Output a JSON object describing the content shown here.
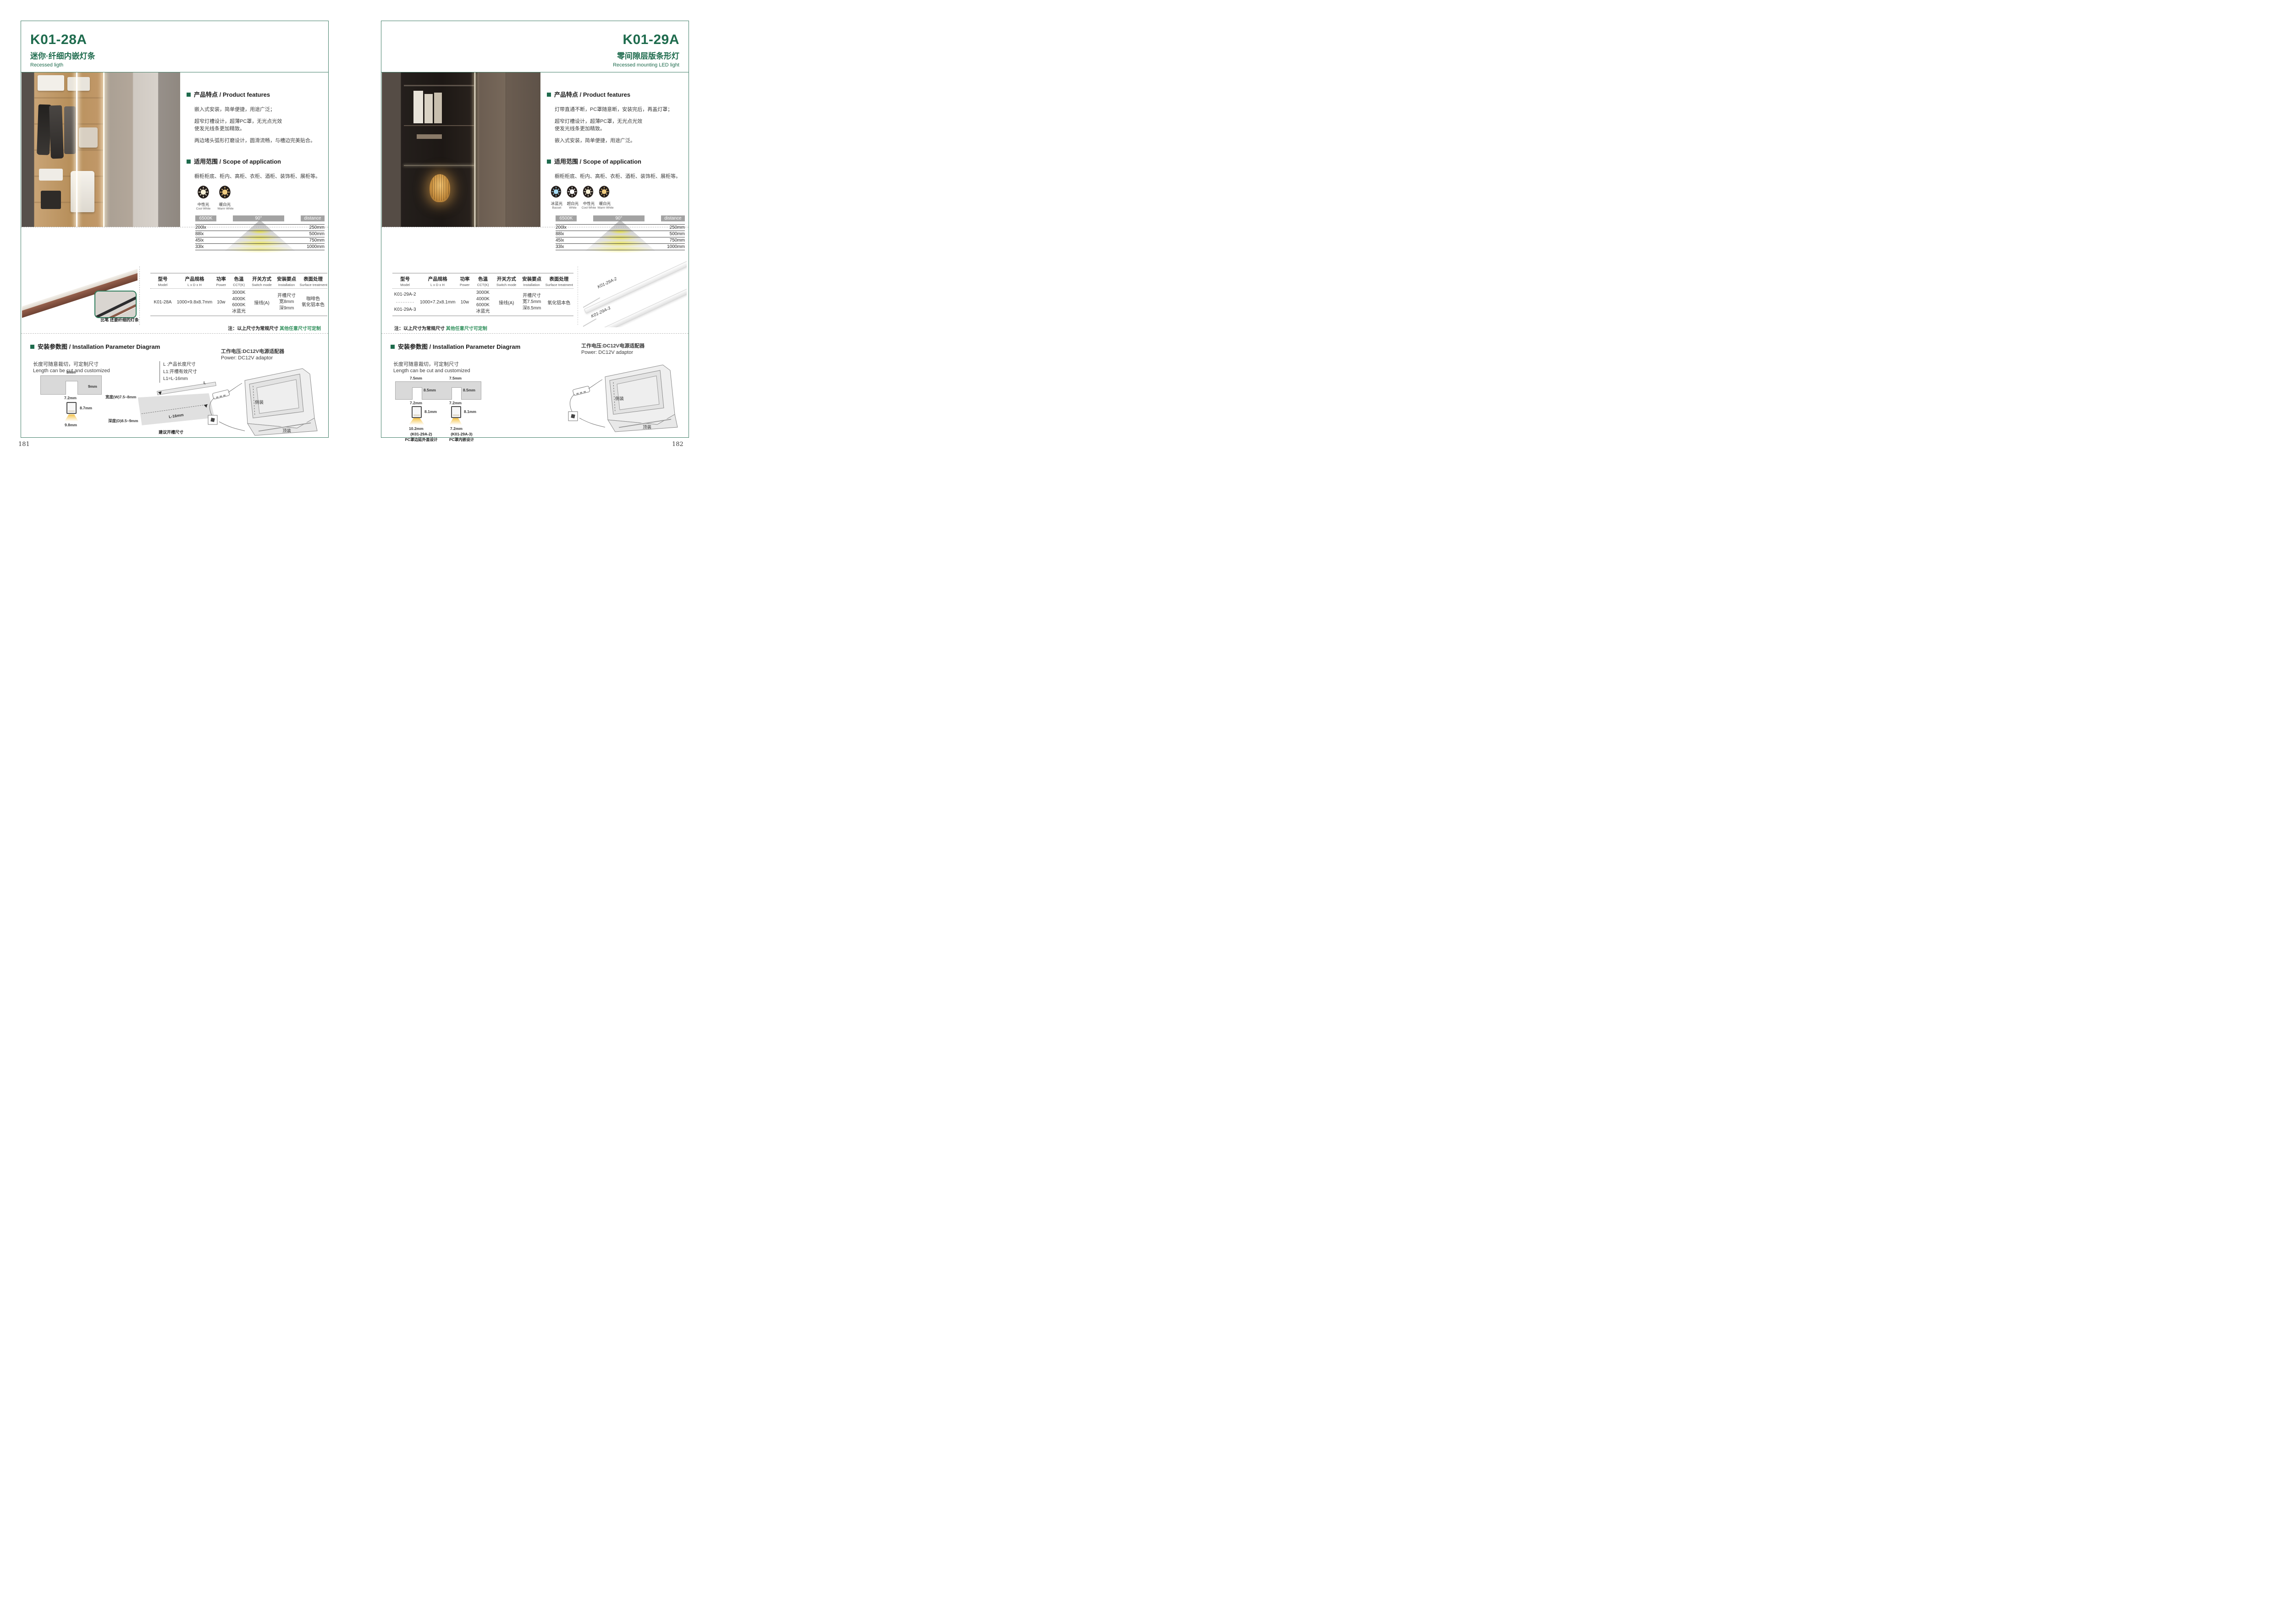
{
  "colors": {
    "accent_green": "#1e6b4d",
    "note_green": "#2f8f5b",
    "bar_gray": "#a3a3a3"
  },
  "left": {
    "page_number": "181",
    "model": "K01-28A",
    "title_cn": "迷你·纤细内嵌灯条",
    "title_en": "Recessed ligth",
    "features_heading": "产品特点 / Product features",
    "features": [
      "嵌入式安装，简单便捷，用途广泛；",
      "超窄灯槽设计，超薄PC罩，无光点光效",
      "使发光线条更加精致。",
      "两边堵头弧形打磨设计，圆滑流畅，与槽边完美贴合。"
    ],
    "scope_heading": "适用范围 / Scope of application",
    "scope_text": "橱柜柜底、柜内、高柜、衣柜、酒柜、装饰柜、展柜等。",
    "light_modes": [
      {
        "icon": "bulb-icon",
        "cn": "中性光",
        "en": "Cool White",
        "color": "#f8f1d7"
      },
      {
        "icon": "bulb-icon",
        "cn": "暖白光",
        "en": "Warm White",
        "color": "#f0cc80"
      }
    ],
    "distance_chart": {
      "cct": "6500K",
      "angle": "90°",
      "distance_label": "distance",
      "rows": [
        {
          "lux": "200lx",
          "distance": "250mm"
        },
        {
          "lux": "88lx",
          "distance": "500mm"
        },
        {
          "lux": "45lx",
          "distance": "750mm"
        },
        {
          "lux": "33lx",
          "distance": "1000mm"
        }
      ]
    },
    "table": {
      "headers": [
        {
          "cn": "型号",
          "en": "Model"
        },
        {
          "cn": "产品规格",
          "en": "L x D x H"
        },
        {
          "cn": "功率",
          "en": "Power"
        },
        {
          "cn": "色温",
          "en": "CCT(K)"
        },
        {
          "cn": "开关方式",
          "en": "Switch mode"
        },
        {
          "cn": "安装要点",
          "en": "Installation"
        },
        {
          "cn": "表面处理",
          "en": "Surface treatment"
        }
      ],
      "row": {
        "model": "K01-28A",
        "size": "1000×9.8x8.7mm",
        "power": "10w",
        "cct": [
          "3000K",
          "4000K",
          "6000K",
          "冰蓝光"
        ],
        "switch": "接线(A)",
        "install": [
          "开槽尺寸",
          "宽8mm",
          "深9mm"
        ],
        "surface": [
          "咖啡色",
          "氧化铝本色"
        ]
      }
    },
    "note": {
      "prefix": "注：以上尺寸为常规尺寸 ",
      "highlight": "其他任意尺寸可定制"
    },
    "strip_caption": "比笔 还要纤细的灯条",
    "install_heading": "安装参数图 / Installation Parameter Diagram",
    "cut_cn": "长度可随意裁切，可定制尺寸",
    "cut_en": "Length can be cut and customized",
    "legend": [
      "L  :产品长度尺寸",
      "L1:开槽有效尺寸",
      "L1=L-16mm"
    ],
    "xsec": {
      "top": "8mm",
      "depth": "9mm",
      "inner": "7.2mm",
      "height": "8.7mm",
      "bottom": "9.8mm"
    },
    "board": {
      "width": "宽度(W)7.5~8mm",
      "depth": "深度(D)8.5~9mm",
      "l": "L",
      "l16": "L-16mm",
      "caption": "建议开槽尺寸"
    },
    "power_cn": "工作电压:DC12V电源适配器",
    "power_en": "Power: DC12V adaptor",
    "side_mount": "侧装",
    "top_mount": "顶装"
  },
  "right": {
    "page_number": "182",
    "model": "K01-29A",
    "title_cn": "零间隙层版条形灯",
    "title_en": "Recessed mounting LED light",
    "features_heading": "产品特点 / Product features",
    "features": [
      "灯带直通不断，PC罩随意断，安装完后，再盖灯罩；",
      "超窄灯槽设计，超薄PC罩，无光点光效",
      "使发光线条更加精致。",
      "嵌入式安装，简单便捷，用途广泛。"
    ],
    "scope_heading": "适用范围 / Scope of application",
    "scope_text": "橱柜柜底、柜内、高柜、衣柜、酒柜、装饰柜、展柜等。",
    "light_modes": [
      {
        "icon": "bulb-icon",
        "cn": "冰蓝光",
        "en": "Basset",
        "color": "#a8dcf5"
      },
      {
        "icon": "bulb-icon",
        "cn": "超白光",
        "en": "White",
        "color": "#ffffff"
      },
      {
        "icon": "bulb-icon",
        "cn": "中性光",
        "en": "Cool White",
        "color": "#f8f1d7"
      },
      {
        "icon": "bulb-icon",
        "cn": "暖白光",
        "en": "Warm White",
        "color": "#f0cc80"
      }
    ],
    "distance_chart": {
      "cct": "6500K",
      "angle": "90°",
      "distance_label": "distance",
      "rows": [
        {
          "lux": "200lx",
          "distance": "250mm"
        },
        {
          "lux": "88lx",
          "distance": "500mm"
        },
        {
          "lux": "45lx",
          "distance": "750mm"
        },
        {
          "lux": "33lx",
          "distance": "1000mm"
        }
      ]
    },
    "table": {
      "headers": [
        {
          "cn": "型号",
          "en": "Model"
        },
        {
          "cn": "产品规格",
          "en": "L x D x H"
        },
        {
          "cn": "功率",
          "en": "Power"
        },
        {
          "cn": "色温",
          "en": "CCT(K)"
        },
        {
          "cn": "开关方式",
          "en": "Switch mode"
        },
        {
          "cn": "安装要点",
          "en": "Installation"
        },
        {
          "cn": "表面处理",
          "en": "Surface treatment"
        }
      ],
      "row": {
        "models": [
          "K01-29A-2",
          "K01-29A-3"
        ],
        "size": "1000×7.2x8.1mm",
        "power": "10w",
        "cct": [
          "3000K",
          "4000K",
          "6000K",
          "冰蓝光"
        ],
        "switch": "接线(A)",
        "install": [
          "开槽尺寸",
          "宽7.5mm",
          "深8.5mm"
        ],
        "surface": [
          "氧化铝本色"
        ]
      }
    },
    "note": {
      "prefix": "注：以上尺寸为常规尺寸 ",
      "highlight": "其他任意尺寸可定制"
    },
    "strip_labels": [
      "K01-29A-2",
      "K01-29A-3"
    ],
    "install_heading": "安装参数图 / Installation Parameter Diagram",
    "cut_cn": "长度可随意裁切，可定制尺寸",
    "cut_en": "Length can be cut and customized",
    "xsec1": {
      "top": "7.5mm",
      "depth": "8.5mm",
      "inner": "7.2mm",
      "height": "8.1mm",
      "bottom": "10.2mm",
      "cap1": "(K01-29A-2)",
      "cap2": "PC罩边延外盖设计"
    },
    "xsec2": {
      "top": "7.5mm",
      "depth": "8.5mm",
      "inner": "7.2mm",
      "height": "8.1mm",
      "bottom": "7.2mm",
      "cap1": "(K01-29A-3)",
      "cap2": "PC罩内嵌设计"
    },
    "power_cn": "工作电压:DC12V电源适配器",
    "power_en": "Power: DC12V adaptor",
    "side_mount": "侧装",
    "top_mount": "顶装"
  }
}
